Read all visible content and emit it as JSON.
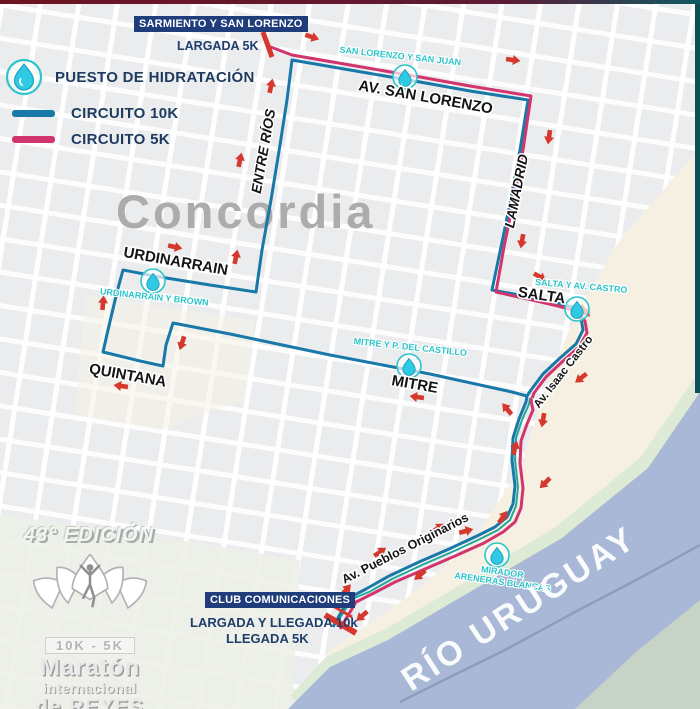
{
  "legend": {
    "hydration_label": "PUESTO DE HIDRATACIÓN",
    "circuit_10k_label": "CIRCUITO 10K",
    "circuit_5k_label": "CIRCUITO 5K"
  },
  "colors": {
    "circuit_10k": "#1878a8",
    "circuit_5k": "#d2346d",
    "coastal_path": "#23a79b",
    "hydration_drop": "#2fc9e4",
    "arrow_red": "#d6382e",
    "navy": "#1e3d6b",
    "river": "#a9b8d6"
  },
  "start_5k": {
    "badge": "SARMIENTO Y SAN LORENZO",
    "label": "LARGADA 5K"
  },
  "finish": {
    "badge": "CLUB COMUNICACIONES",
    "line1": "LARGADA Y LLEGADA 10k",
    "line2": "LLEGADA 5K"
  },
  "city_label": "Concordia",
  "river_label": "RÍO URUGUAY",
  "streets": {
    "av_san_lorenzo": "AV. SAN LORENZO",
    "entre_rios": "ENTRE RÍOS",
    "lamadrid": "LAMADRID",
    "urdinarrain": "URDINARRAIN",
    "quintana": "QUINTANA",
    "mitre": "MITRE",
    "salta": "SALTA",
    "av_isaac_castro": "Av. Isaac Castro",
    "av_pueblos_originarios": "Av. Pueblos Originarios"
  },
  "hydration_stations": {
    "san_lorenzo_san_juan": "SAN LORENZO Y SAN JUAN",
    "urdinarrain_brown": "URDINARRAIN Y BROWN",
    "salta_castro": "SALTA Y AV. CASTRO",
    "mitre_castillo": "MITRE Y P. DEL CASTILLO",
    "mirador_line1": "MIRADOR",
    "mirador_line2": "ARENERAS BLANCAS"
  },
  "logo": {
    "edition": "43° EDICIÓN",
    "distances": "10K - 5K",
    "line1": "Maratón",
    "line2": "internacional",
    "line3": "de REYES",
    "city": "concordia"
  }
}
